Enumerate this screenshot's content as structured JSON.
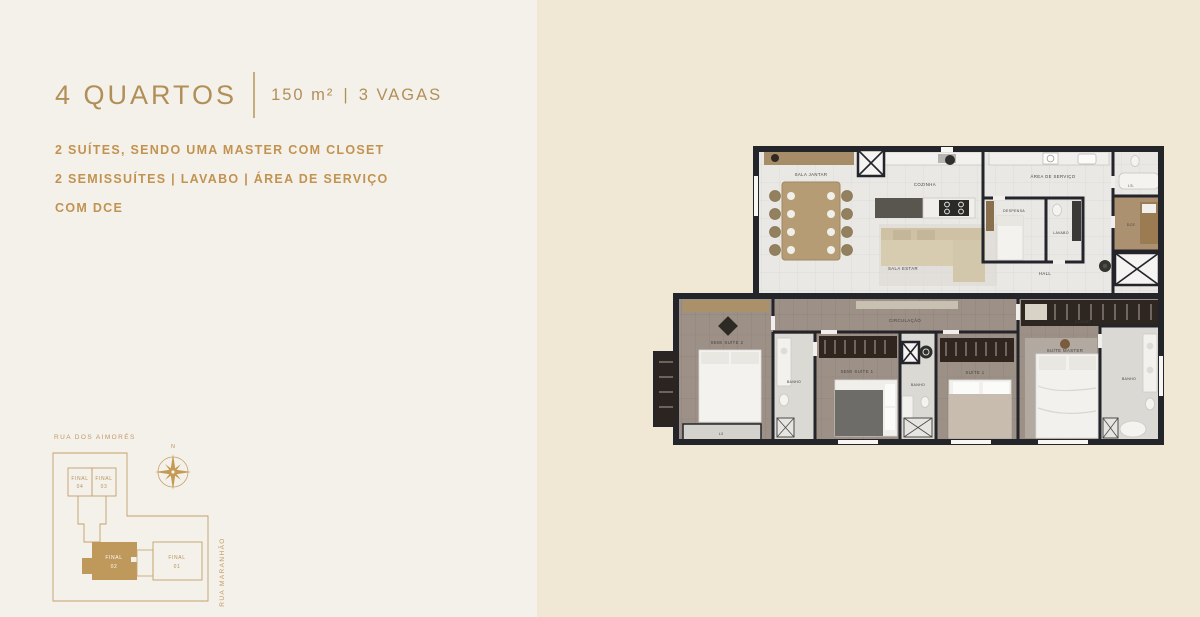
{
  "header": {
    "title": "4 QUARTOS",
    "area": "150 m²",
    "separator": "|",
    "parking": "3 VAGAS"
  },
  "features": {
    "line1": "2 SUÍTES, SENDO UMA MASTER COM CLOSET",
    "line2": "2 SEMISSUÍTES | LAVABO | ÁREA DE SERVIÇO",
    "line3": "COM DCE"
  },
  "floorplan": {
    "labels": {
      "sala_jantar": "SALA JANTAR",
      "cozinha": "COZINHA",
      "area_servico": "ÁREA DE SERVIÇO",
      "despensa": "DESPENSA",
      "lavabo": "LAVABO",
      "sala_estar": "SALA ESTAR",
      "hall": "HALL",
      "is": "I.S.",
      "dce": "DCE",
      "circulacao": "CIRCULAÇÃO",
      "semi_suite_2": "SEMI SUÍTE 2",
      "semi_suite_1": "SEMI SUÍTE 1",
      "suite_1": "SUÍTE 1",
      "suite_master": "SUÍTE MASTER",
      "closet": "CLOSET",
      "banho": "BANHO",
      "l3": "L3"
    }
  },
  "siteplan": {
    "street_top": "RUA DOS AIMORÉS",
    "street_right": "RUA MARANHÃO",
    "compass_north": "N",
    "final_label": "FINAL",
    "units": [
      {
        "number": "04"
      },
      {
        "number": "03"
      },
      {
        "number": "02"
      },
      {
        "number": "01"
      }
    ]
  },
  "colors": {
    "accent_gold": "#b8935a",
    "accent_gold_deep": "#bf995c",
    "left_bg": "#f4f1ea",
    "right_bg": "#f0e8d4",
    "wall_dark": "#23252b"
  }
}
